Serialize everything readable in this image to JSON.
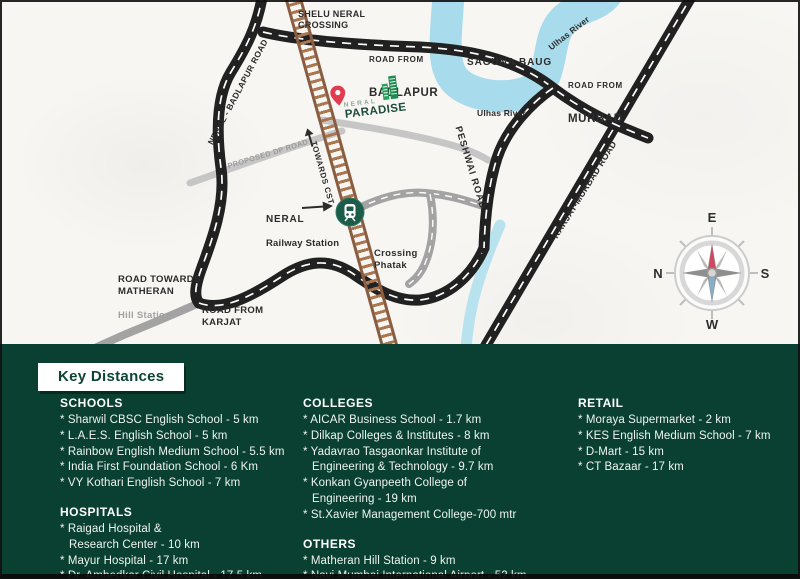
{
  "colors": {
    "panel_green": "#0a4032",
    "road_black": "#212121",
    "road_gray": "#a3a3a3",
    "river_blue": "#a8dbeb",
    "railway_brown": "#8a5d41",
    "pin_red": "#e23b4f",
    "logo_green": "#1d4c3c",
    "station_green": "#1d5c49",
    "compass_red": "#d4455f",
    "compass_blue": "#85aec8"
  },
  "map": {
    "labels": {
      "shelu_crossing": "SHELU NERAL\nCROSSING",
      "road_from_badlapur_prefix": "ROAD FROM",
      "road_from_badlapur_name": "BADLAPUR",
      "saguna_baug": "SAGUNA BAUG",
      "ulhas_river_upper": "Ulhas River",
      "ulhas_river_lower": "Ulhas River",
      "road_from_murbad_prefix": "ROAD FROM",
      "road_from_murbad_name": "MURBAD",
      "neral_badlapur_road": "NERAL - BADLAPUR ROAD",
      "karjat_murbad_road": "KARJAT-MURBAD ROAD",
      "peshwai_road": "PESHWAI ROAD",
      "proposed_dp_road": "PROPOSED DP ROAD",
      "towards_cst": "TOWARDS CST",
      "station_line1": "NERAL",
      "station_line2": "Railway Station",
      "crossing_phatak": "Crossing\nPhatak",
      "road_towards_matheran": "ROAD TOWARDS\nMATHERAN",
      "matheran_sub": "Hill Station",
      "road_from_karjat": "ROAD FROM\nKARJAT"
    },
    "logo": {
      "line1": "NERAL",
      "line2": "PARADISE"
    },
    "compass": {
      "top": "E",
      "left": "N",
      "right": "S",
      "bottom": "W"
    }
  },
  "panel": {
    "title": "Key Distances",
    "columns": [
      {
        "sections": [
          {
            "heading": "SCHOOLS",
            "items": [
              "* Sharwil CBSC English School - 5 km",
              "* L.A.E.S. English School - 5 km",
              "* Rainbow English Medium School - 5.5 km",
              "* India First Foundation School - 6 Km",
              "* VY Kothari English School - 7 km"
            ]
          },
          {
            "heading": "HOSPITALS",
            "items": [
              "* Raigad Hospital &\nResearch Center - 10 km",
              "* Mayur Hospital - 17 km",
              "* Dr. Ambedkar Civil Hospital - 17.5 km"
            ]
          }
        ]
      },
      {
        "sections": [
          {
            "heading": "COLLEGES",
            "items": [
              "* AICAR Business School - 1.7 km",
              "* Dilkap Colleges & Institutes - 8 km",
              "* Yadavrao Tasgaonkar Institute of\nEngineering & Technology - 9.7 km",
              "* Konkan Gyanpeeth College of\nEngineering - 19 km",
              "* St.Xavier Management College-700 mtr"
            ]
          },
          {
            "heading": "OTHERS",
            "items": [
              "* Matheran Hill Station - 9 km",
              "* Navi Mumbai International Airport - 52 km"
            ]
          }
        ]
      },
      {
        "sections": [
          {
            "heading": "RETAIL",
            "items": [
              "* Moraya Supermarket - 2 km",
              "* KES English Medium School - 7 km",
              "* D-Mart - 15 km",
              "* CT Bazaar - 17 km"
            ]
          }
        ]
      }
    ]
  }
}
